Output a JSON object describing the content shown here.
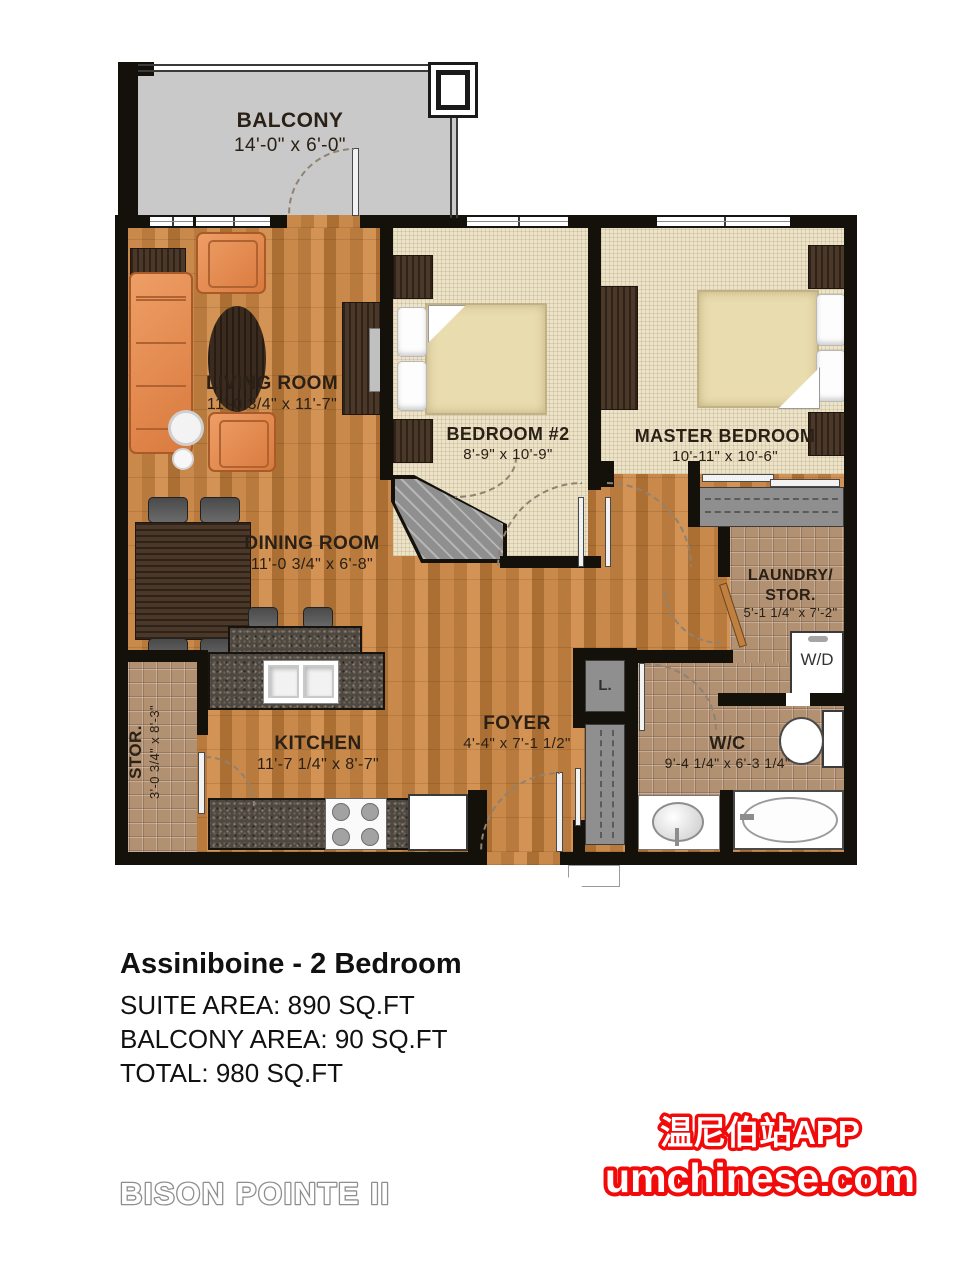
{
  "plan": {
    "balcony": {
      "name": "BALCONY",
      "dims": "14'-0\" x 6'-0\""
    },
    "living": {
      "name": "LIVING ROOM",
      "dims": "11'-0 3/4\" x 11'-7\""
    },
    "bedroom2": {
      "name": "BEDROOM #2",
      "dims": "8'-9\" x 10'-9\""
    },
    "master": {
      "name": "MASTER BEDROOM",
      "dims": "10'-11\" x 10'-6\""
    },
    "dining": {
      "name": "DINING ROOM",
      "dims": "11'-0 3/4\" x 6'-8\""
    },
    "laundry": {
      "name": "LAUNDRY/",
      "name2": "STOR.",
      "dims": "5'-1 1/4\" x 7'-2\""
    },
    "kitchen": {
      "name": "KITCHEN",
      "dims": "11'-7 1/4\" x 8'-7\""
    },
    "foyer": {
      "name": "FOYER",
      "dims": "4'-4\" x 7'-1 1/2\""
    },
    "wc": {
      "name": "W/C",
      "dims": "9'-4 1/4\" x 6'-3 1/4\""
    },
    "stor": {
      "name": "STOR.",
      "dims": "3'-0 3/4\" x 8'-3\""
    },
    "labels": {
      "washer_dryer": "W/D",
      "linen_closet": "L."
    }
  },
  "summary": {
    "title": "Assiniboine - 2 Bedroom",
    "suite_area": "SUITE AREA: 890 SQ.FT",
    "balcony_area": "BALCONY AREA: 90 SQ.FT",
    "total": "TOTAL: 980 SQ.FT"
  },
  "watermark": {
    "line1": "温尼伯站APP",
    "line2": "umchinese.com",
    "color": "#f20a0a"
  },
  "footer": {
    "brand": "BISON POINTE II"
  },
  "colors": {
    "wall": "#14100a",
    "wood_floor": "#c9894a",
    "carpet": "#ece3c8",
    "tile": "#b29173",
    "balcony_floor": "#c9c9c9",
    "sofa_orange": "#d97a3e",
    "watermark_red": "#f20a0a"
  }
}
